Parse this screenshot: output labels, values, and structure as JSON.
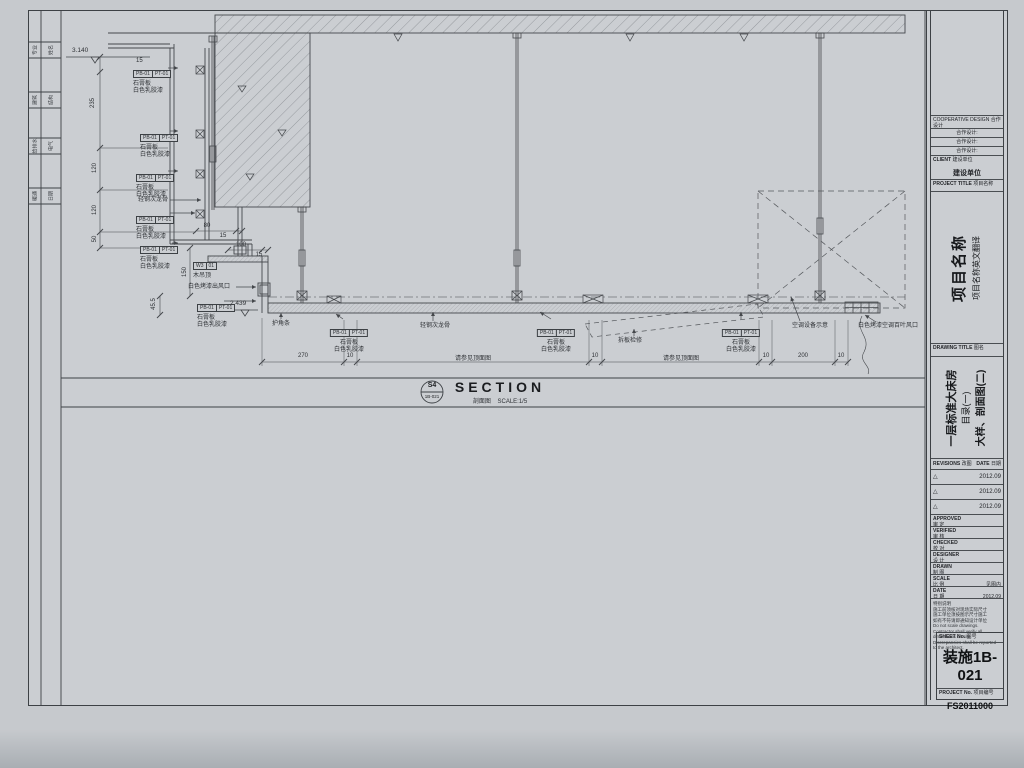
{
  "strip": {
    "rows": [
      {
        "a": "专业",
        "b": "姓名"
      },
      {
        "a": "建筑",
        "b": "结构"
      },
      {
        "a": "给排水",
        "b": "电气"
      },
      {
        "a": "暖通",
        "b": "日期"
      }
    ]
  },
  "draw": {
    "mat": {
      "c1": "PB-01",
      "c2": "PT-01",
      "m1": "石膏板",
      "m2": "白色乳胶漆"
    },
    "w3": {
      "c1": "W3",
      "c2": "01",
      "name": "木吊顶"
    },
    "keel": "轻钢次龙骨",
    "outlet": "白色烤漆出风口",
    "corner": "护角条",
    "access": "拆板检修",
    "ac": "空调设备示意",
    "louver": "白色烤漆空调百叶风口",
    "lv_top": "3.140",
    "lv_ceil": "2.439",
    "d15": "15",
    "d235": "235",
    "d120": "120",
    "d50": "50",
    "d150": "150",
    "d455": "45.5",
    "d80": "80",
    "d100": "100",
    "d270": "270",
    "d200": "200",
    "d10": "10",
    "ref": "请参见顶面图"
  },
  "bar": {
    "bubble_top": "S4",
    "bubble_bottom": "1B-021",
    "title": "SECTION",
    "sub_cn": "剖面图",
    "scale": "SCALE:1/5"
  },
  "tb": {
    "coop_en": "COOPERATIVE DESIGN",
    "coop_cn": "合作设计",
    "coop_rows": [
      "合作设计:",
      "合作设计:",
      "合作设计:"
    ],
    "client_en": "CLIENT",
    "client_cn": "建设单位",
    "client_val": "建设单位",
    "pt_en": "PROJECT TITLE",
    "pt_cn": "项目名称",
    "pname_main": "项目名称",
    "pname_sub": "项目名称英文翻译",
    "dt_en": "DRAWING TITLE",
    "dt_cn": "图名",
    "dt_lines": [
      "一层标准大床房",
      "目录(一)",
      "大样、剖面图(二)"
    ],
    "rev_en": "REVISIONS",
    "rev_cn": "改图",
    "date_en": "DATE",
    "date_cn": "日期",
    "revs": [
      {
        "mark": "△",
        "date": "2012.09"
      },
      {
        "mark": "△",
        "date": "2012.09"
      },
      {
        "mark": "△",
        "date": "2012.09"
      }
    ],
    "signs": [
      {
        "en": "APPROVED",
        "cn": "审 定",
        "val": ""
      },
      {
        "en": "VERIFIED",
        "cn": "审 核",
        "val": ""
      },
      {
        "en": "CHECKED",
        "cn": "校 对",
        "val": ""
      },
      {
        "en": "DESIGNER",
        "cn": "设 计",
        "val": ""
      },
      {
        "en": "DRAWN",
        "cn": "制 图",
        "val": ""
      },
      {
        "en": "SCALE",
        "cn": "比 例",
        "val": "见图内"
      },
      {
        "en": "DATE",
        "cn": "日 期",
        "val": "2012.09"
      }
    ],
    "notes": [
      "特别说明",
      "施工前须核对现场实际尺寸",
      "施工单位须按图示尺寸施工",
      "如有不符请即通知设计单位",
      "Do not scale drawings.",
      "Contractor shall verify all dimensions on site.",
      "Discrepancies shall be reported to the architect."
    ],
    "sheet_en": "SHEET No.",
    "sheet_cn": "图号",
    "sheet_no": "装施1B-021",
    "proj_en": "PROJECT No.",
    "proj_cn": "项目编号",
    "proj_no": "FS2011000"
  }
}
